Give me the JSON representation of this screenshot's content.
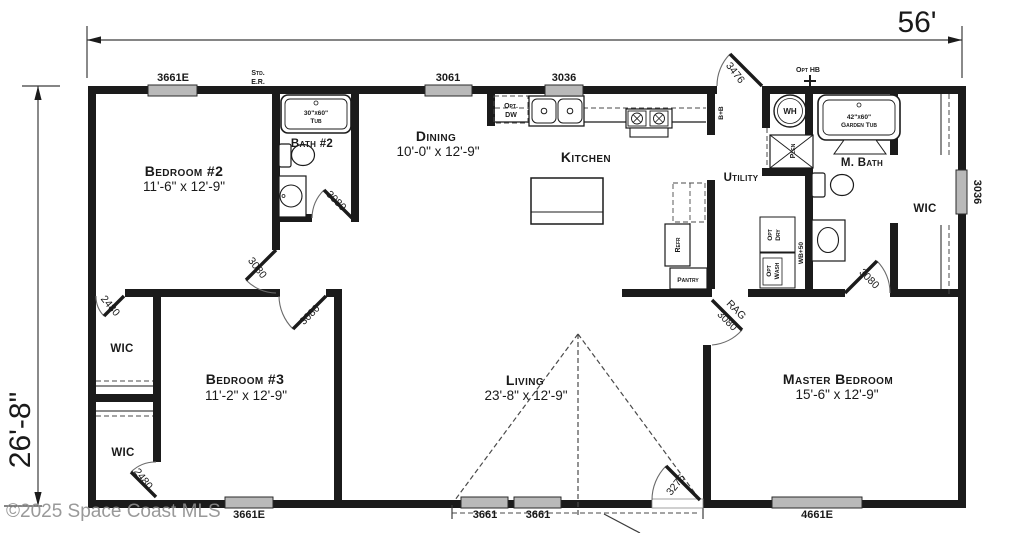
{
  "dimensions": {
    "width": "56'",
    "height": "26'-8\""
  },
  "watermark": "©2025 Space Coast MLS",
  "rooms": {
    "bedroom2": {
      "name": "Bedroom #2",
      "dims": "11'-6\" x 12'-9\""
    },
    "bath2": {
      "name": "Bath #2"
    },
    "dining": {
      "name": "Dining",
      "dims": "10'-0\" x 12'-9\""
    },
    "kitchen": {
      "name": "Kitchen"
    },
    "utility": {
      "name": "Utility"
    },
    "mbath": {
      "name": "M. Bath"
    },
    "wic_master": {
      "name": "WIC"
    },
    "wic_bedroom2": {
      "name": "WIC"
    },
    "wic_bedroom3": {
      "name": "WIC"
    },
    "bedroom3": {
      "name": "Bedroom #3",
      "dims": "11'-2\" x 12'-9\""
    },
    "living": {
      "name": "Living",
      "dims": "23'-8\" x 12'-9\""
    },
    "master": {
      "name": "Master Bedroom",
      "dims": "15'-6\" x 12'-9\""
    },
    "pantry": {
      "name": "Pantry"
    }
  },
  "windows": {
    "top_bedroom2": "3661E",
    "top_dining": "3061",
    "top_kitchen": "3036",
    "right_wic": "3036",
    "bottom_bedroom3": "3661E",
    "bottom_living_a": "3661",
    "bottom_living_b": "3661",
    "bottom_master": "4661E"
  },
  "doors": {
    "back": "3476",
    "bath2": "3080",
    "bedroom2": "3080",
    "bedroom3": "3080",
    "wic_bedroom2": "2480",
    "wic_bedroom3": "2480",
    "master_rag": "RAG",
    "master": "3080",
    "mbath": "3080",
    "front": "3276"
  },
  "fixtures": {
    "tub2_size": "30\"x60\"",
    "tub2_label": "Tub",
    "garden_tub_size": "42\"x60\"",
    "garden_tub_label": "Garden Tub",
    "water_heater": "WH",
    "plenum": "Plen",
    "refrigerator": "Refr",
    "dryer_line1": "Opt",
    "dryer_line2": "Dry",
    "washer_line1": "Opt",
    "washer_line2": "Wash",
    "washer_box": "WB+50",
    "dishwasher_line1": "Opt.",
    "dishwasher_line2": "DW",
    "base_backsplash": "B+B",
    "hose_bib": "Opt HB",
    "egress_line1": "Std.",
    "egress_line2": "E.R."
  }
}
